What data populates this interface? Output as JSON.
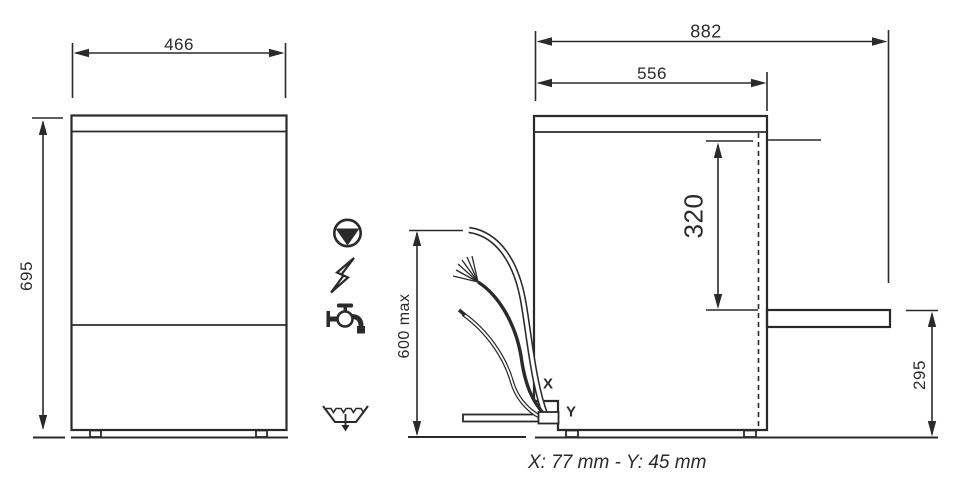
{
  "colors": {
    "line": "#2b2a2a",
    "background": "#ffffff"
  },
  "front_view": {
    "width": "466",
    "height": "695"
  },
  "side_view": {
    "overall_depth": "882",
    "top_depth": "556",
    "door_opening_height": "320",
    "open_door_height": "295",
    "connection_height": "600 max",
    "drain_x": "X",
    "drain_y": "Y"
  },
  "icons": {
    "pump": "pump-icon",
    "electricity": "electricity-icon",
    "water_supply": "water-tap-icon",
    "drain": "drain-icon"
  },
  "caption": "X: 77 mm - Y: 45 mm"
}
